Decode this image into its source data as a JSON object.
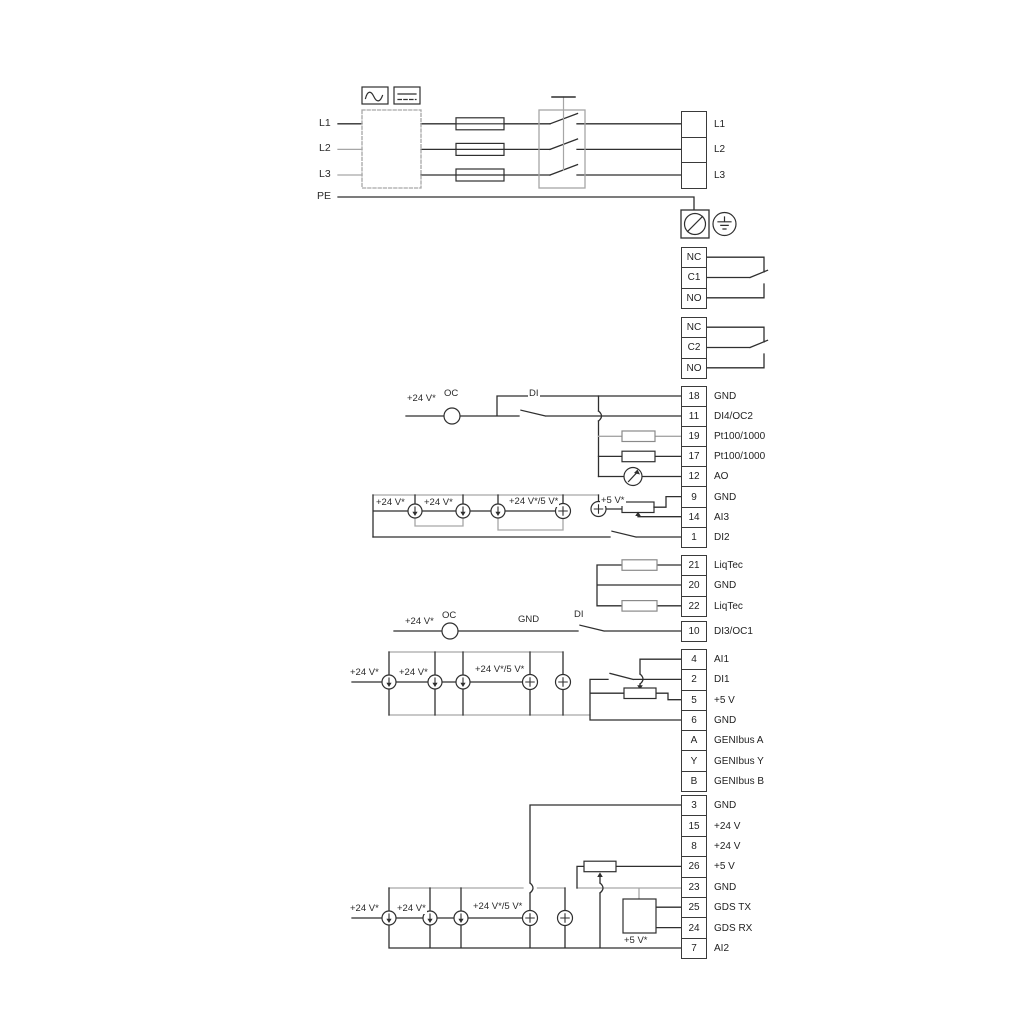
{
  "power_in": {
    "l1": "L1",
    "l2": "L2",
    "l3": "L3",
    "pe": "PE"
  },
  "strips": {
    "power_out": {
      "rows": [
        {
          "n": "",
          "t": "L1"
        },
        {
          "n": "",
          "t": "L2"
        },
        {
          "n": "",
          "t": "L3"
        }
      ]
    },
    "relay1": {
      "rows": [
        {
          "n": "NC",
          "t": ""
        },
        {
          "n": "C1",
          "t": ""
        },
        {
          "n": "NO",
          "t": ""
        }
      ]
    },
    "relay2": {
      "rows": [
        {
          "n": "NC",
          "t": ""
        },
        {
          "n": "C2",
          "t": ""
        },
        {
          "n": "NO",
          "t": ""
        }
      ]
    },
    "main1": {
      "rows": [
        {
          "n": "18",
          "t": "GND"
        },
        {
          "n": "11",
          "t": "DI4/OC2"
        },
        {
          "n": "19",
          "t": "Pt100/1000"
        },
        {
          "n": "17",
          "t": "Pt100/1000"
        },
        {
          "n": "12",
          "t": "AO"
        },
        {
          "n": "9",
          "t": "GND"
        },
        {
          "n": "14",
          "t": "AI3"
        },
        {
          "n": "1",
          "t": "DI2"
        }
      ]
    },
    "liqtec": {
      "rows": [
        {
          "n": "21",
          "t": "LiqTec"
        },
        {
          "n": "20",
          "t": "GND"
        },
        {
          "n": "22",
          "t": "LiqTec"
        }
      ]
    },
    "di3": {
      "rows": [
        {
          "n": "10",
          "t": "DI3/OC1"
        }
      ]
    },
    "main2": {
      "rows": [
        {
          "n": "4",
          "t": "AI1"
        },
        {
          "n": "2",
          "t": "DI1"
        },
        {
          "n": "5",
          "t": "+5 V"
        },
        {
          "n": "6",
          "t": "GND"
        },
        {
          "n": "A",
          "t": "GENIbus A"
        },
        {
          "n": "Y",
          "t": "GENIbus Y"
        },
        {
          "n": "B",
          "t": "GENIbus B"
        }
      ]
    },
    "main3": {
      "rows": [
        {
          "n": "3",
          "t": "GND"
        },
        {
          "n": "15",
          "t": "+24 V"
        },
        {
          "n": "8",
          "t": "+24 V"
        },
        {
          "n": "26",
          "t": "+5 V"
        },
        {
          "n": "23",
          "t": "GND"
        },
        {
          "n": "25",
          "t": "GDS TX"
        },
        {
          "n": "24",
          "t": "GDS RX"
        },
        {
          "n": "7",
          "t": "AI2"
        }
      ]
    }
  },
  "labels": {
    "v24": "+24 V*",
    "v24v5": "+24 V*/5 V*",
    "v5": "+5 V*",
    "oc": "OC",
    "di": "DI",
    "gnd": "GND"
  },
  "colors": {
    "wire": "#2f2f2f",
    "wire_gray": "#a6a6a6"
  }
}
